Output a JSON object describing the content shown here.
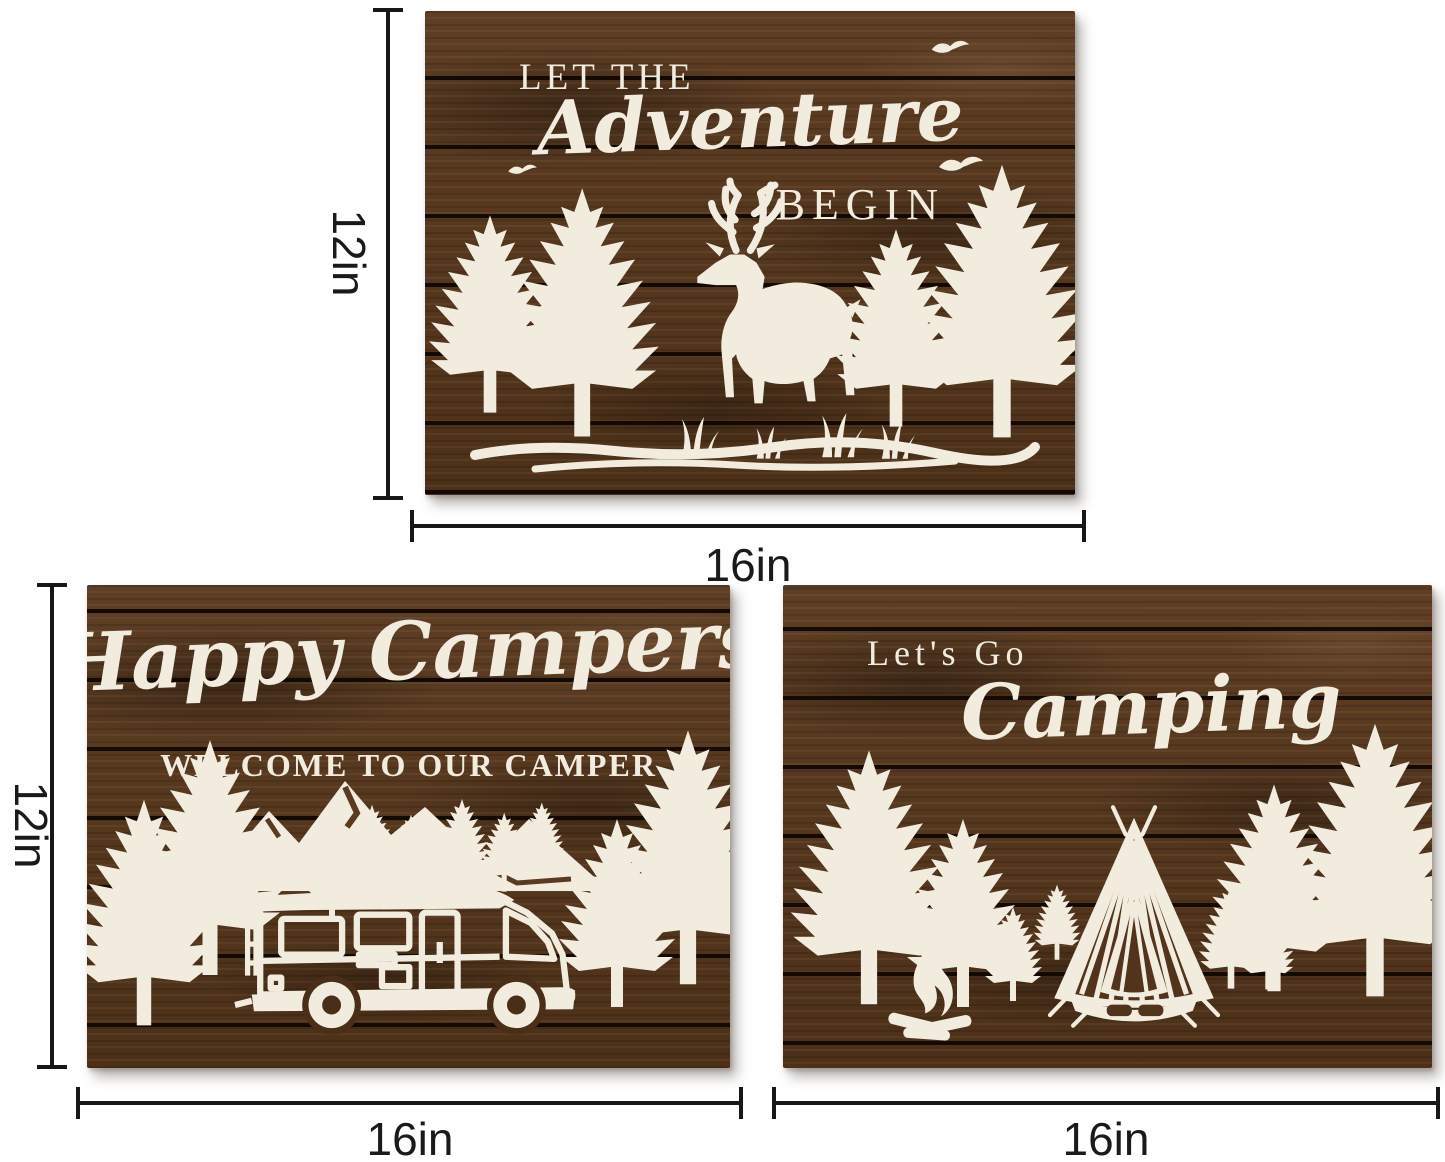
{
  "page": {
    "background": "#ffffff"
  },
  "colors": {
    "wood_brown": "#553620",
    "plank_gap": "#140a04",
    "artwork_cream": "#f2ecdf",
    "dimension_line": "#171717",
    "dimension_text": "#1a1a1a"
  },
  "dimensions": {
    "top_sign": {
      "height_label": "12in",
      "width_label": "16in"
    },
    "bottom_left_sign": {
      "height_label": "12in",
      "width_label": "16in"
    },
    "bottom_right_sign": {
      "width_label": "16in"
    }
  },
  "signs": {
    "adventure": {
      "line1": "LET THE",
      "line2": "Adventure",
      "line3": "BEGIN"
    },
    "happy_campers": {
      "headline": "Happy Campers",
      "subline": "WELCOME TO OUR CAMPER"
    },
    "lets_go_camping": {
      "line1": "Let's Go",
      "line2": "Camping"
    }
  }
}
